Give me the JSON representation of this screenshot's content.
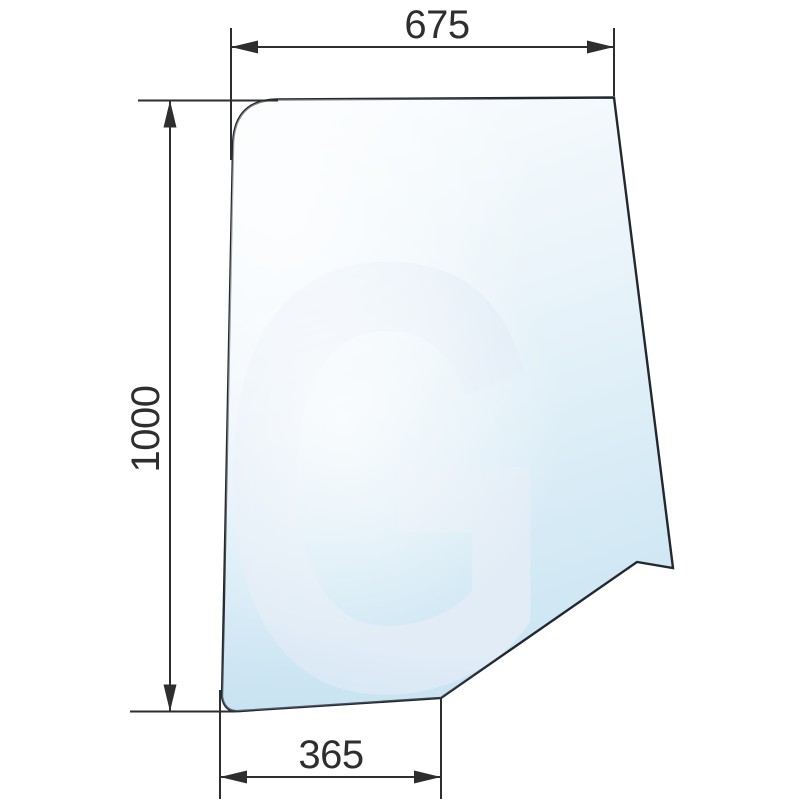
{
  "title": "Glass panel technical drawing",
  "watermark": {
    "letter": "G"
  },
  "dimensions": {
    "top_width": "675",
    "left_height": "1000",
    "bottom_width": "365"
  },
  "theme": {
    "background": "#ffffff",
    "outline_color": "#232830",
    "dimension_color": "#2e2e2e",
    "glass_top": "#fbfdfe",
    "glass_mid": "#eaf4fa",
    "glass_bottom": "#cde6f3",
    "watermark_color": "#e2edf7",
    "sheen_color": "#ffffff",
    "band_color": "#b9d9ee"
  }
}
